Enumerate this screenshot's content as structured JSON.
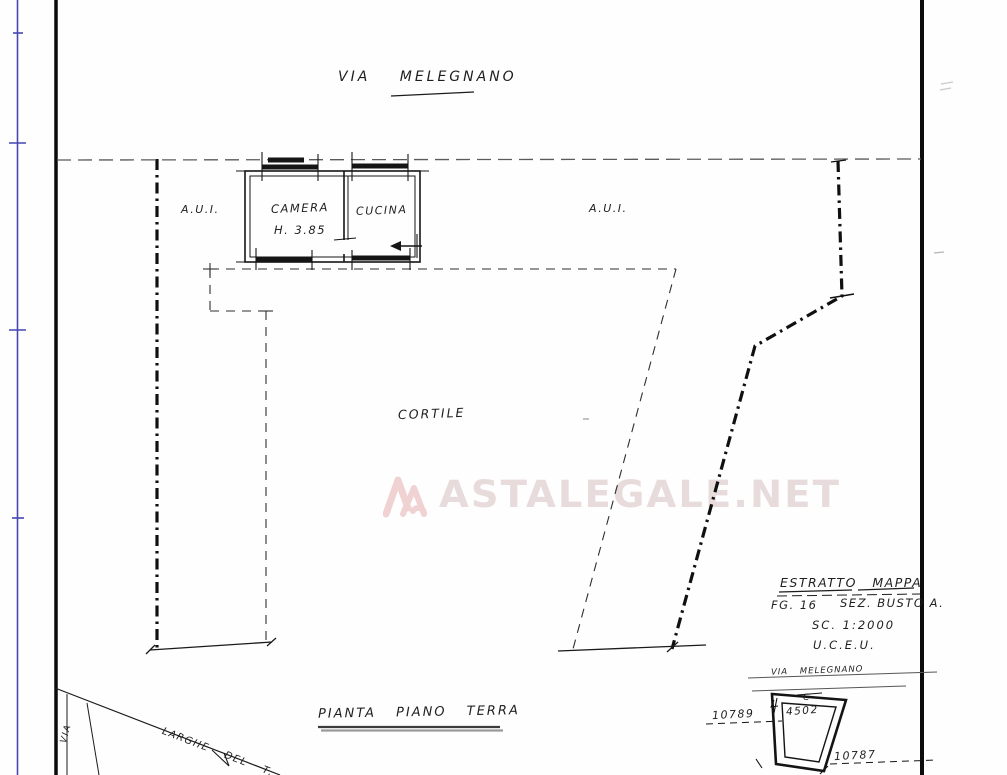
{
  "colors": {
    "ink": "#1f1f1f",
    "margin_line_blue": "#4646b4",
    "watermark_pink": "#e8dbdb",
    "underline_gray": "#9a9a9a"
  },
  "plan": {
    "street_label": "VIA MELEGNANO",
    "aui_left": "A.U.I.",
    "aui_right": "A.U.I.",
    "rooms": {
      "camera": "CAMERA",
      "camera_height": "H. 3.85",
      "cucina": "CUCINA"
    },
    "courtyard": "CORTILE",
    "title": "PIANTA PIANO TERRA",
    "corner_street_diagonal": "LARGHE DEL T.",
    "corner_street_vertical": "VIA"
  },
  "watermark": {
    "text": "ASTALEGALE.NET"
  },
  "map_extract": {
    "title": "ESTRATTO MAPPA",
    "sheet": "FG. 16",
    "section": "SEZ. BUSTO A.",
    "scale": "SC. 1:2000",
    "office": "U.C.E.U.",
    "street": "VIA MELEGNANO",
    "parcels": {
      "letter": "C",
      "number": "4502",
      "left": "10789",
      "bottom_right": "10787"
    }
  }
}
